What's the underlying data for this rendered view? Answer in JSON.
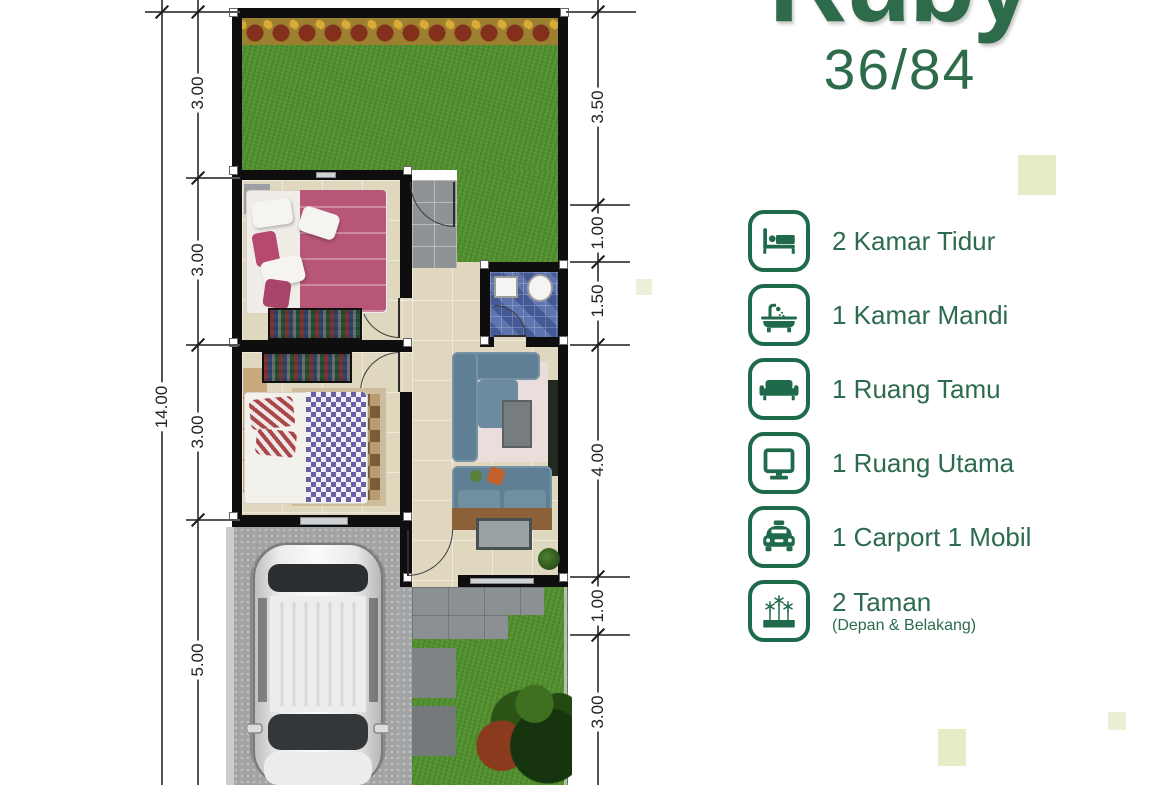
{
  "title": {
    "name": "Ruby",
    "size": "36/84"
  },
  "legend": {
    "items": [
      {
        "icon": "bed-icon",
        "label": "2 Kamar Tidur"
      },
      {
        "icon": "bathtub-icon",
        "label": "1 Kamar Mandi"
      },
      {
        "icon": "sofa-icon",
        "label": "1 Ruang Tamu"
      },
      {
        "icon": "monitor-icon",
        "label": "1 Ruang Utama"
      },
      {
        "icon": "car-icon",
        "label": "1 Carport 1 Mobil"
      },
      {
        "icon": "garden-icon",
        "label": "2 Taman",
        "sublabel": "(Depan & Belakang)"
      }
    ]
  },
  "dimensions": {
    "left_total": "14.00",
    "left_segments": [
      "3.00",
      "3.00",
      "3.00",
      "5.00"
    ],
    "right_segments": [
      "3.50",
      "1.00",
      "1.50",
      "4.00",
      "1.00",
      "3.00"
    ]
  },
  "colors": {
    "brand_green": "#2E6B4A",
    "icon_green": "#1F6A4B",
    "soft_green_square": "#E4EDC6",
    "grass_green": "#549130",
    "floor_beige": "#E0D7BF",
    "bathroom_blue": "#5068A8"
  }
}
